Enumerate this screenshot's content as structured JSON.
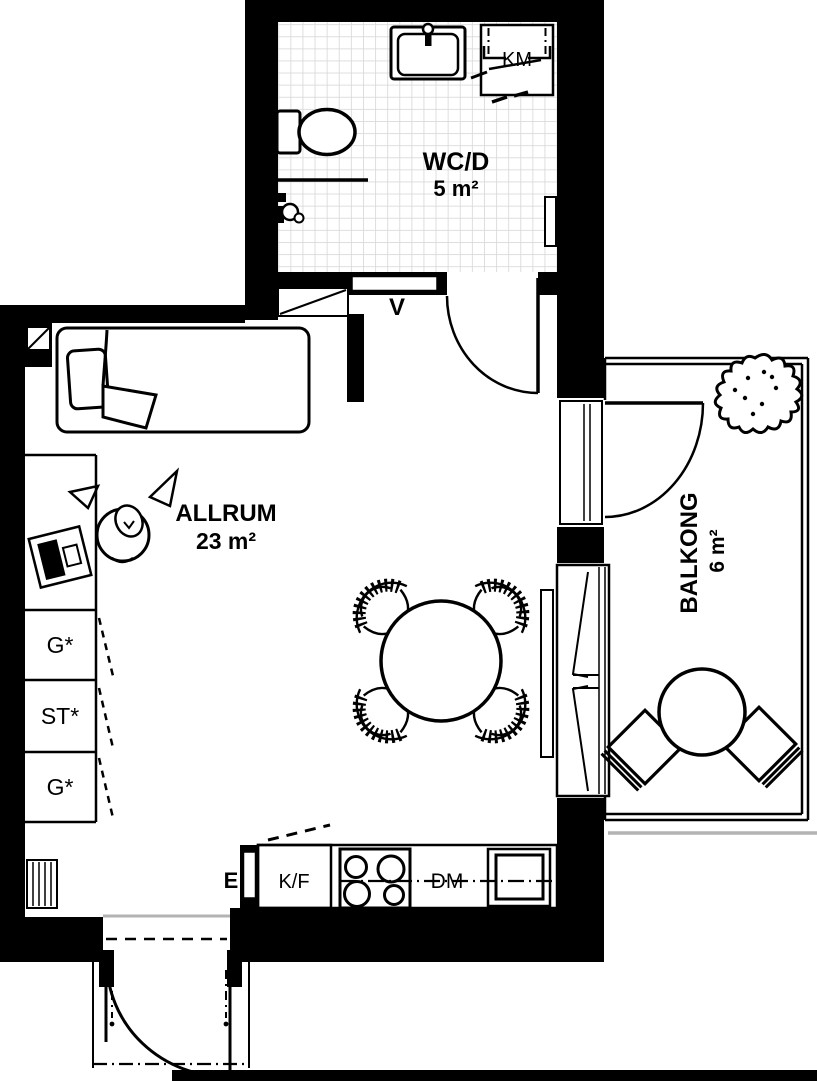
{
  "rooms": {
    "bathroom": {
      "name": "WC/D",
      "area": "5 m²"
    },
    "living_room": {
      "name": "ALLRUM",
      "area": "23 m²"
    },
    "balcony": {
      "name": "BALKONG",
      "area": "6 m²"
    }
  },
  "labels": {
    "washing_machine": "KM",
    "ventilation_shaft": "V",
    "electrical_cabinet": "E",
    "fridge_freezer": "K/F",
    "dishwasher": "DM"
  },
  "closets": [
    "G*",
    "ST*",
    "G*"
  ],
  "colors": {
    "wall": "#000000",
    "line": "#000000",
    "paper": "#ffffff",
    "tile": "#d9d9d9",
    "threshold": "#b3b3b3"
  }
}
